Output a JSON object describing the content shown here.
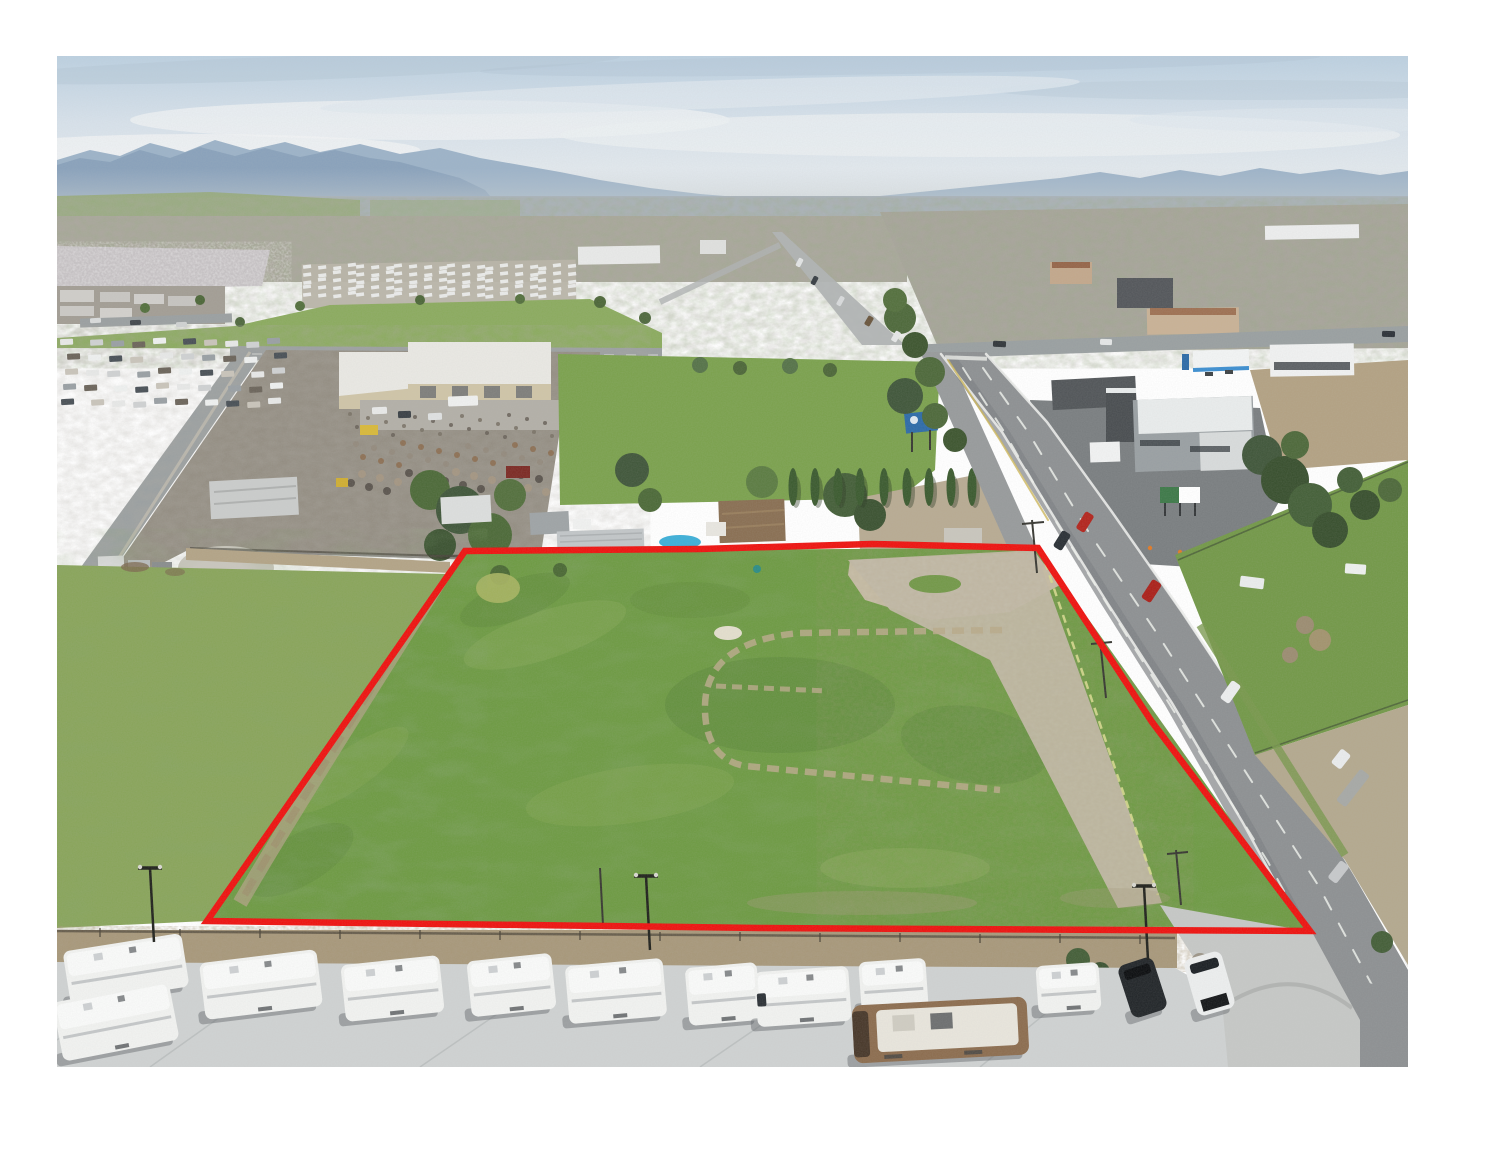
{
  "photo": {
    "alt": "Aerial drone photograph of a flat vacant land parcel outlined with a red property boundary, bordered by a highway on the right, an RV sales lot with a row of white travel trailers in the foreground, a scrap yard and warehouse behind, and a small city, orchards and distant mountains on the horizon",
    "frame_color": "#ffffff"
  },
  "palette": {
    "sky_top": "#bcd0e0",
    "sky_mid": "#dde6ec",
    "cloud_white": "#f0f3f4",
    "cloud_slate": "#b4c6d6",
    "mountain_far": "#9db3c8",
    "mountain_near": "#7f99b4",
    "haze": "#c9cfd2",
    "distant_fields": "#98aa7c",
    "city_base": "#aaa79c",
    "orchard": "#c6c2c4",
    "mobile_park_base": "#b8b4a8",
    "big_field": "#8cab60",
    "lawn": "#7ca24f",
    "left_field": "#8aa55c",
    "parcel_grass": "#6f9b45",
    "dirt": "#b2a386",
    "gravel": "#c7bda6",
    "apron": "#c3bba8",
    "road": "#9ba0a1",
    "highway": "#8e9193",
    "concrete": "#cfd2d2",
    "corner_concrete": "#c6c8c6",
    "brush": "#a8987a",
    "tree_green": "#55713f",
    "tree_dark": "#425833",
    "cypress": "#3d5c31",
    "warehouse_tan": "#cfc5a8",
    "warehouse_roof": "#e9e8e3",
    "junkyard_base": "#948e83",
    "pool_blue": "#3fb0d8",
    "gas_blue": "#3e8fd0",
    "billboard_blue": "#2f6ca8",
    "billboard_green": "#3f7a4a",
    "cone_orange": "#e07b28",
    "rv_white": "#f1f2f0",
    "motorhome_brown": "#8d6e50",
    "boundary_red": "#ee1512"
  },
  "boundary": {
    "color": "#ee1512",
    "width": 6.5,
    "points": "465,551 700,549 872,544 1038,548 1152,722 1310,931 760,928 207,921"
  },
  "scene": {
    "cypress_xs": [
      793,
      815,
      838,
      860,
      884,
      907,
      929,
      951,
      972
    ],
    "light_poles": [
      {
        "x": 150,
        "y": 868
      },
      {
        "x": 646,
        "y": 876
      },
      {
        "x": 1144,
        "y": 886
      }
    ],
    "rv_row": [
      {
        "x": 66,
        "y": 942,
        "w": 120,
        "h": 54,
        "r": -9,
        "t": "trailer"
      },
      {
        "x": 57,
        "y": 991,
        "w": 118,
        "h": 60,
        "r": -11,
        "t": "trailer"
      },
      {
        "x": 202,
        "y": 956,
        "w": 118,
        "h": 57,
        "r": -7,
        "t": "trailer"
      },
      {
        "x": 343,
        "y": 960,
        "w": 99,
        "h": 57,
        "r": -6,
        "t": "trailer"
      },
      {
        "x": 469,
        "y": 957,
        "w": 85,
        "h": 56,
        "r": -6,
        "t": "trailer"
      },
      {
        "x": 567,
        "y": 962,
        "w": 98,
        "h": 58,
        "r": -5,
        "t": "trailer"
      },
      {
        "x": 687,
        "y": 965,
        "w": 72,
        "h": 58,
        "r": -5,
        "t": "trailer"
      },
      {
        "x": 756,
        "y": 969,
        "w": 94,
        "h": 55,
        "r": -4,
        "t": "classC"
      },
      {
        "x": 860,
        "y": 960,
        "w": 67,
        "h": 50,
        "r": -4,
        "t": "trailer"
      },
      {
        "x": 1037,
        "y": 964,
        "w": 63,
        "h": 48,
        "r": -4,
        "t": "trailer"
      },
      {
        "x": 853,
        "y": 1001,
        "w": 175,
        "h": 58,
        "r": -3,
        "t": "motorhome"
      },
      {
        "x": 1124,
        "y": 960,
        "w": 37,
        "h": 55,
        "r": -18,
        "t": "suv_dark"
      },
      {
        "x": 1190,
        "y": 954,
        "w": 39,
        "h": 59,
        "r": -16,
        "t": "suv_white"
      }
    ],
    "highway_vehicles": [
      {
        "x": 1080,
        "y": 512,
        "w": 10,
        "h": 20,
        "r": 32,
        "c": "#b3271f"
      },
      {
        "x": 1057,
        "y": 531,
        "w": 10,
        "h": 19,
        "r": 32,
        "c": "#2c3237"
      },
      {
        "x": 1146,
        "y": 580,
        "w": 11,
        "h": 22,
        "r": 33,
        "c": "#ab221b"
      },
      {
        "x": 1225,
        "y": 681,
        "w": 11,
        "h": 22,
        "r": 35,
        "c": "#eceeee"
      },
      {
        "x": 1335,
        "y": 750,
        "w": 12,
        "h": 18,
        "r": 38,
        "c": "#e9ebec"
      },
      {
        "x": 1347,
        "y": 768,
        "w": 12,
        "h": 40,
        "r": 38,
        "c": "#a7a9a6"
      },
      {
        "x": 1333,
        "y": 861,
        "w": 11,
        "h": 22,
        "r": 38,
        "c": "#c7c9cb"
      }
    ],
    "street_vehicles": [
      {
        "x": 797,
        "y": 258,
        "w": 5,
        "h": 9,
        "r": 27,
        "c": "#e2e4e4"
      },
      {
        "x": 812,
        "y": 276,
        "w": 5,
        "h": 9,
        "r": 28,
        "c": "#3a4046"
      },
      {
        "x": 838,
        "y": 296,
        "w": 5,
        "h": 10,
        "r": 29,
        "c": "#d8dadb"
      },
      {
        "x": 866,
        "y": 316,
        "w": 6,
        "h": 10,
        "r": 30,
        "c": "#6b573f"
      },
      {
        "x": 893,
        "y": 331,
        "w": 6,
        "h": 11,
        "r": 31,
        "c": "#e6e7e7"
      },
      {
        "x": 993,
        "y": 341,
        "w": 13,
        "h": 6,
        "r": 3,
        "c": "#33383c"
      },
      {
        "x": 1100,
        "y": 339,
        "w": 12,
        "h": 6,
        "r": 2,
        "c": "#e4e6e6"
      },
      {
        "x": 1382,
        "y": 331,
        "w": 13,
        "h": 6,
        "r": 2,
        "c": "#2f343a"
      },
      {
        "x": 1240,
        "y": 577,
        "w": 24,
        "h": 11,
        "r": 7,
        "c": "#eaecec"
      },
      {
        "x": 1345,
        "y": 564,
        "w": 21,
        "h": 10,
        "r": 4,
        "c": "#eef0ef"
      },
      {
        "x": 372,
        "y": 407,
        "w": 15,
        "h": 7,
        "r": -2,
        "c": "#e8e9e8"
      },
      {
        "x": 398,
        "y": 411,
        "w": 13,
        "h": 7,
        "r": -2,
        "c": "#3c4247"
      },
      {
        "x": 428,
        "y": 413,
        "w": 14,
        "h": 7,
        "r": -2,
        "c": "#dfe1e1"
      },
      {
        "x": 448,
        "y": 396,
        "w": 30,
        "h": 10,
        "r": -2,
        "c": "#eff0ef"
      },
      {
        "x": 90,
        "y": 318,
        "w": 11,
        "h": 5,
        "r": -3,
        "c": "#d9dbdb"
      },
      {
        "x": 130,
        "y": 320,
        "w": 11,
        "h": 5,
        "r": -2,
        "c": "#454b50"
      },
      {
        "x": 176,
        "y": 322,
        "w": 11,
        "h": 5,
        "r": -2,
        "c": "#cfd1d1"
      }
    ],
    "car_lot": {
      "rows": [
        340,
        355,
        370,
        385,
        400
      ],
      "x0": 64,
      "x1": 286,
      "step": 23,
      "colors": [
        "#e7e8e7",
        "#cfd1d2",
        "#9aa0a4",
        "#6d665c",
        "#eef0ef",
        "#4b5258",
        "#c9c4ba"
      ]
    },
    "mobile_park": {
      "x0": 306,
      "x1": 566,
      "y0": 266,
      "y1": 300,
      "dx": 13,
      "dy": 7
    },
    "junk_scatter": {
      "x0": 350,
      "x1": 556,
      "y0": 414,
      "y1": 500,
      "n": 70,
      "colors": [
        "#7b7468",
        "#8d6f52",
        "#a59783",
        "#6b655c",
        "#938b7d",
        "#57514a"
      ]
    }
  }
}
